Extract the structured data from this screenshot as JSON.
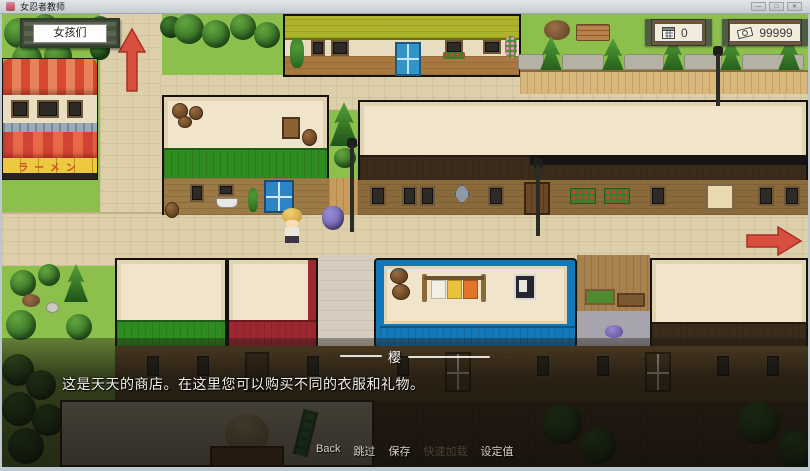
{
  "window": {
    "title": "女忍者教师",
    "controls": {
      "minimize": "—",
      "maximize": "□",
      "close": "✕"
    }
  },
  "hud": {
    "girls_button": "女孩们",
    "day_counter": "0",
    "money": "99999"
  },
  "map": {
    "ramen_sign": "ラーメン",
    "exit_arrows": [
      "up",
      "right"
    ]
  },
  "dialogue": {
    "speaker": "樱",
    "text": "这是天天的商店。在这里您可以购买不同的衣服和礼物。"
  },
  "quick_menu": {
    "items": [
      {
        "label": "Back",
        "enabled": true
      },
      {
        "label": "跳过",
        "enabled": true
      },
      {
        "label": "保存",
        "enabled": true
      },
      {
        "label": "快速加载",
        "enabled": false
      },
      {
        "label": "设定值",
        "enabled": true
      }
    ]
  },
  "colors": {
    "grass": "#8cbf4c",
    "road": "#dccfa9",
    "arrow": "#d9493a",
    "roof_olive": "#adb32a",
    "roof_green": "#2f8c20",
    "roof_blue": "#1478b8",
    "roof_red": "#9e2832",
    "roof_dark": "#3b2b1b",
    "cream": "#f0e4cb"
  }
}
